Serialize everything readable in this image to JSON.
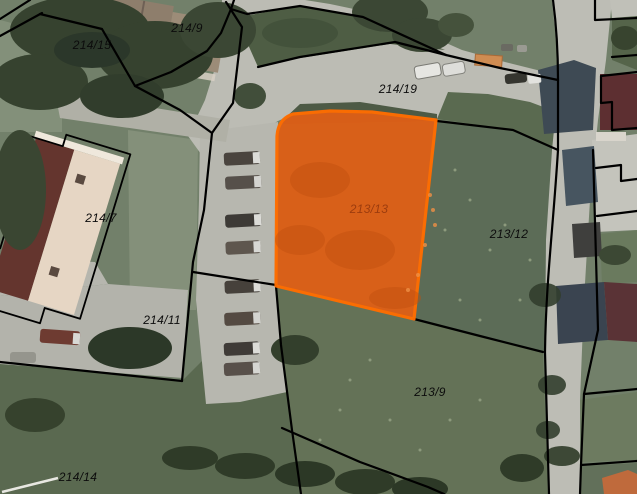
{
  "map": {
    "kind": "cadastral-parcel-map-over-aerial-photo",
    "highlighted_parcel": "213/13",
    "colors": {
      "highlight_fill": "#DC5F17",
      "highlight_border": "#FF6D00",
      "highlight_label": "#9C3C0E",
      "parcel_boundary": "#000000",
      "parcel_label": "#0C0C0C"
    },
    "parcels": [
      {
        "label": "214/15"
      },
      {
        "label": "214/9"
      },
      {
        "label": "214/19"
      },
      {
        "label": "214/7"
      },
      {
        "label": "213/13",
        "highlighted": true
      },
      {
        "label": "213/12"
      },
      {
        "label": "214/11"
      },
      {
        "label": "213/9"
      },
      {
        "label": "214/14"
      }
    ]
  }
}
